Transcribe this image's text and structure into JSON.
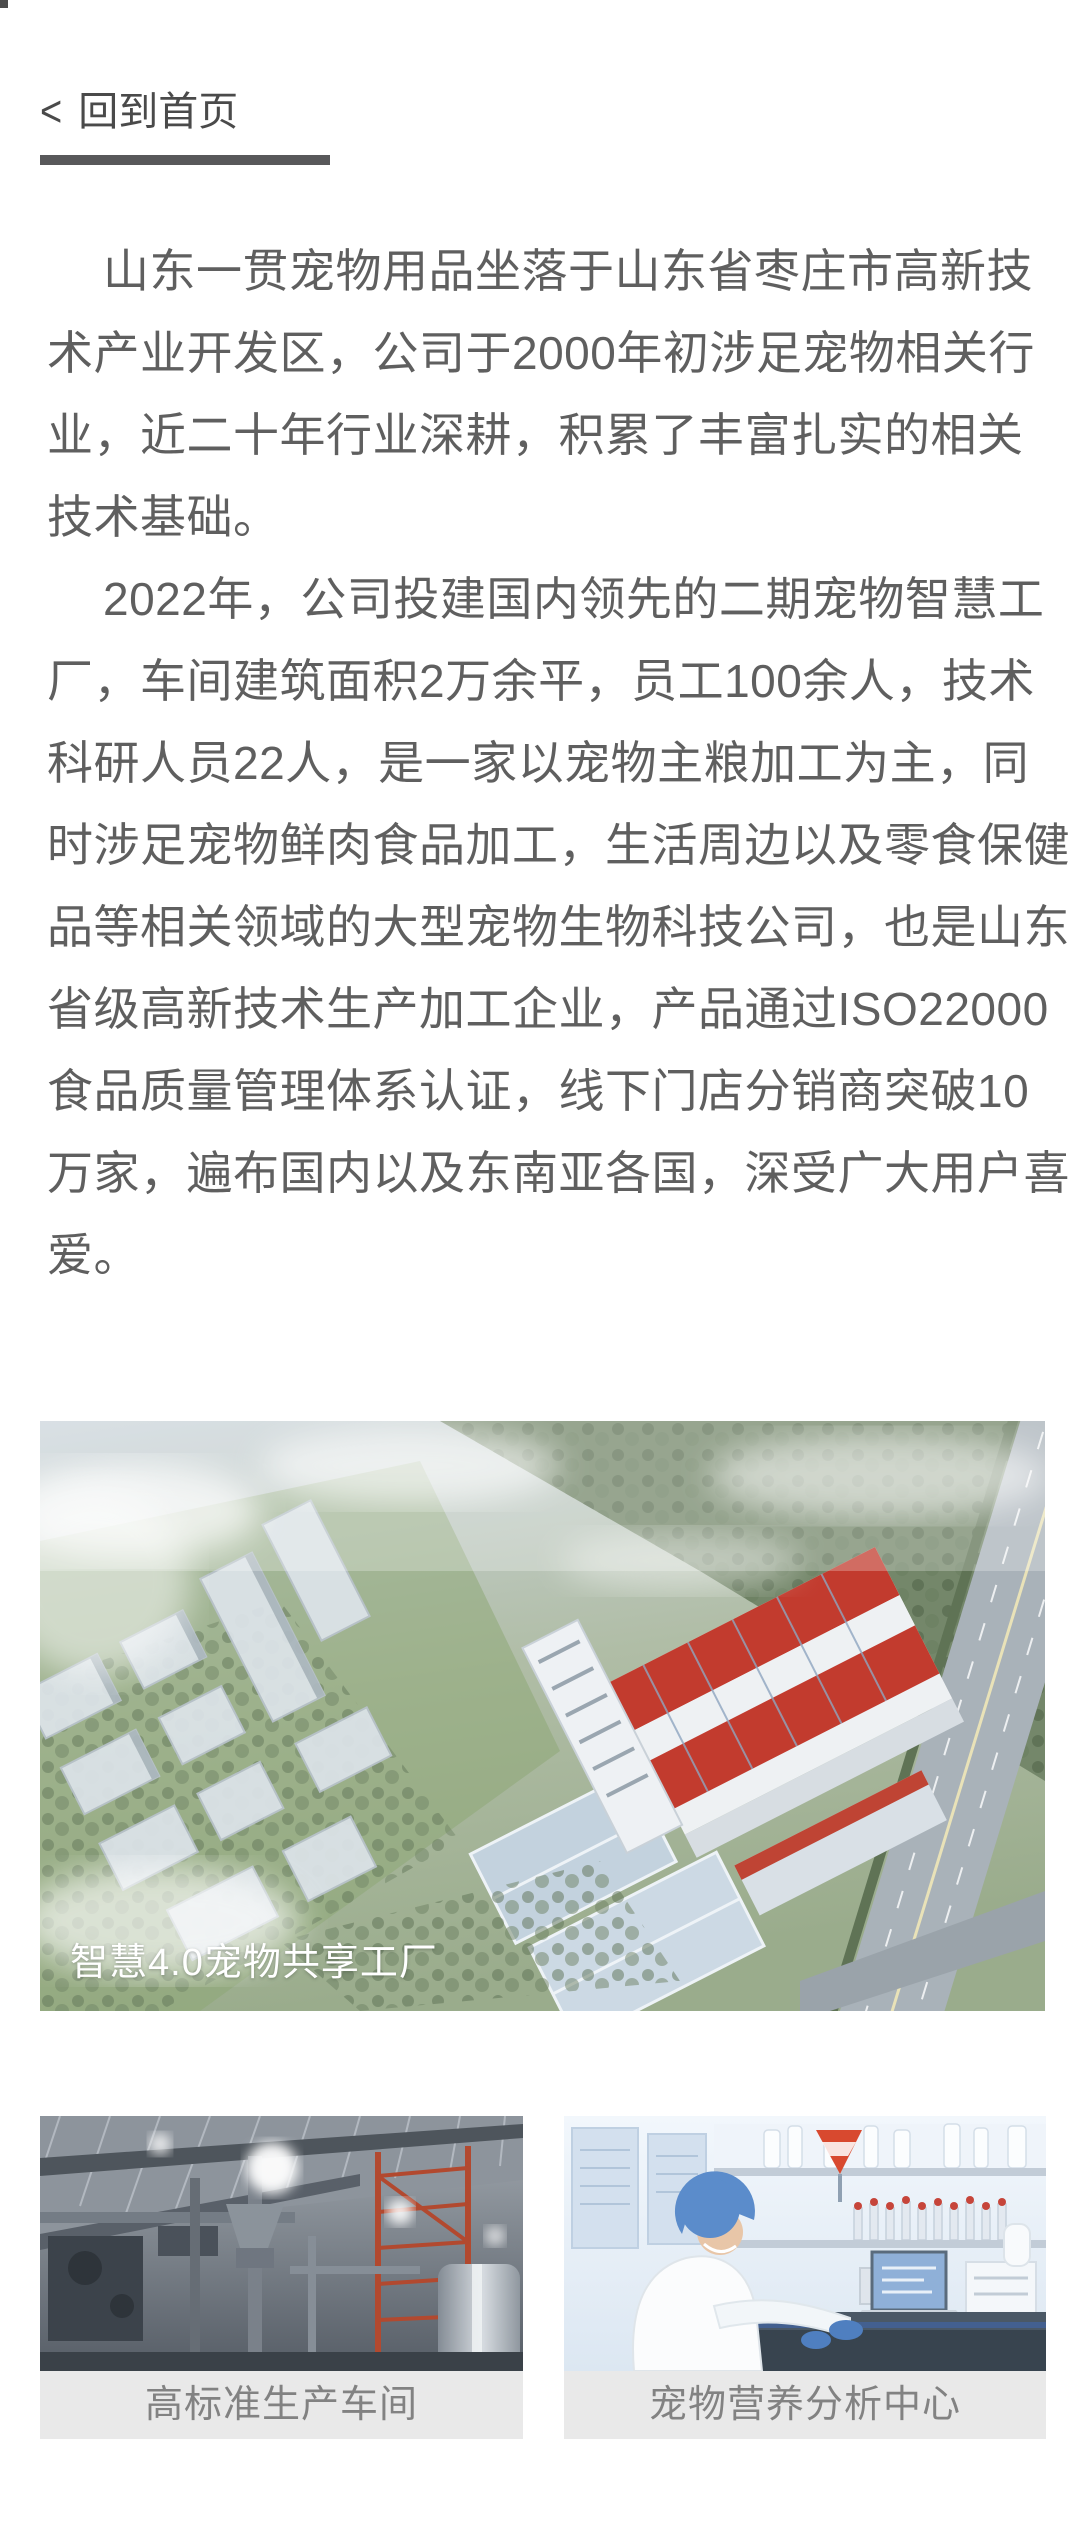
{
  "page": {
    "background": "#ffffff"
  },
  "back_nav": {
    "chevron": "<",
    "label": "回到首页"
  },
  "article": {
    "paragraphs": [
      {
        "lines": [
          "山东一贯宠物用品坐落于山东省枣庄市高新技",
          "术产业开发区，公司于2000年初涉足宠物相关行",
          "业，近二十年行业深耕，积累了丰富扎实的相关",
          "技术基础。"
        ]
      },
      {
        "lines": [
          "2022年，公司投建国内领先的二期宠物智慧工",
          "厂，车间建筑面积2万余平，员工100余人，技术",
          "科研人员22人，是一家以宠物主粮加工为主，同",
          "时涉足宠物鲜肉食品加工，生活周边以及零食保健",
          "品等相关领域的大型宠物生物科技公司，也是山东",
          "省级高新技术生产加工企业，产品通过ISO22000",
          "食品质量管理体系认证，线下门店分销商突破10",
          "万家，遍布国内以及东南亚各国，深受广大用户喜",
          "爱。"
        ]
      }
    ]
  },
  "figures": {
    "main": {
      "caption": "智慧4.0宠物共享工厂"
    },
    "items": [
      {
        "caption": "高标准生产车间"
      },
      {
        "caption": "宠物营养分析中心"
      }
    ]
  },
  "colors": {
    "body_text": "#5f5f5f",
    "back_link": "#4a4a4a",
    "underline_bar": "#58585a",
    "caption_bar_bg": "#e9e9e9",
    "caption_text": "#828282",
    "photo_caption_text": "#ffffff",
    "factory_roof_red": "#c23b2e"
  }
}
